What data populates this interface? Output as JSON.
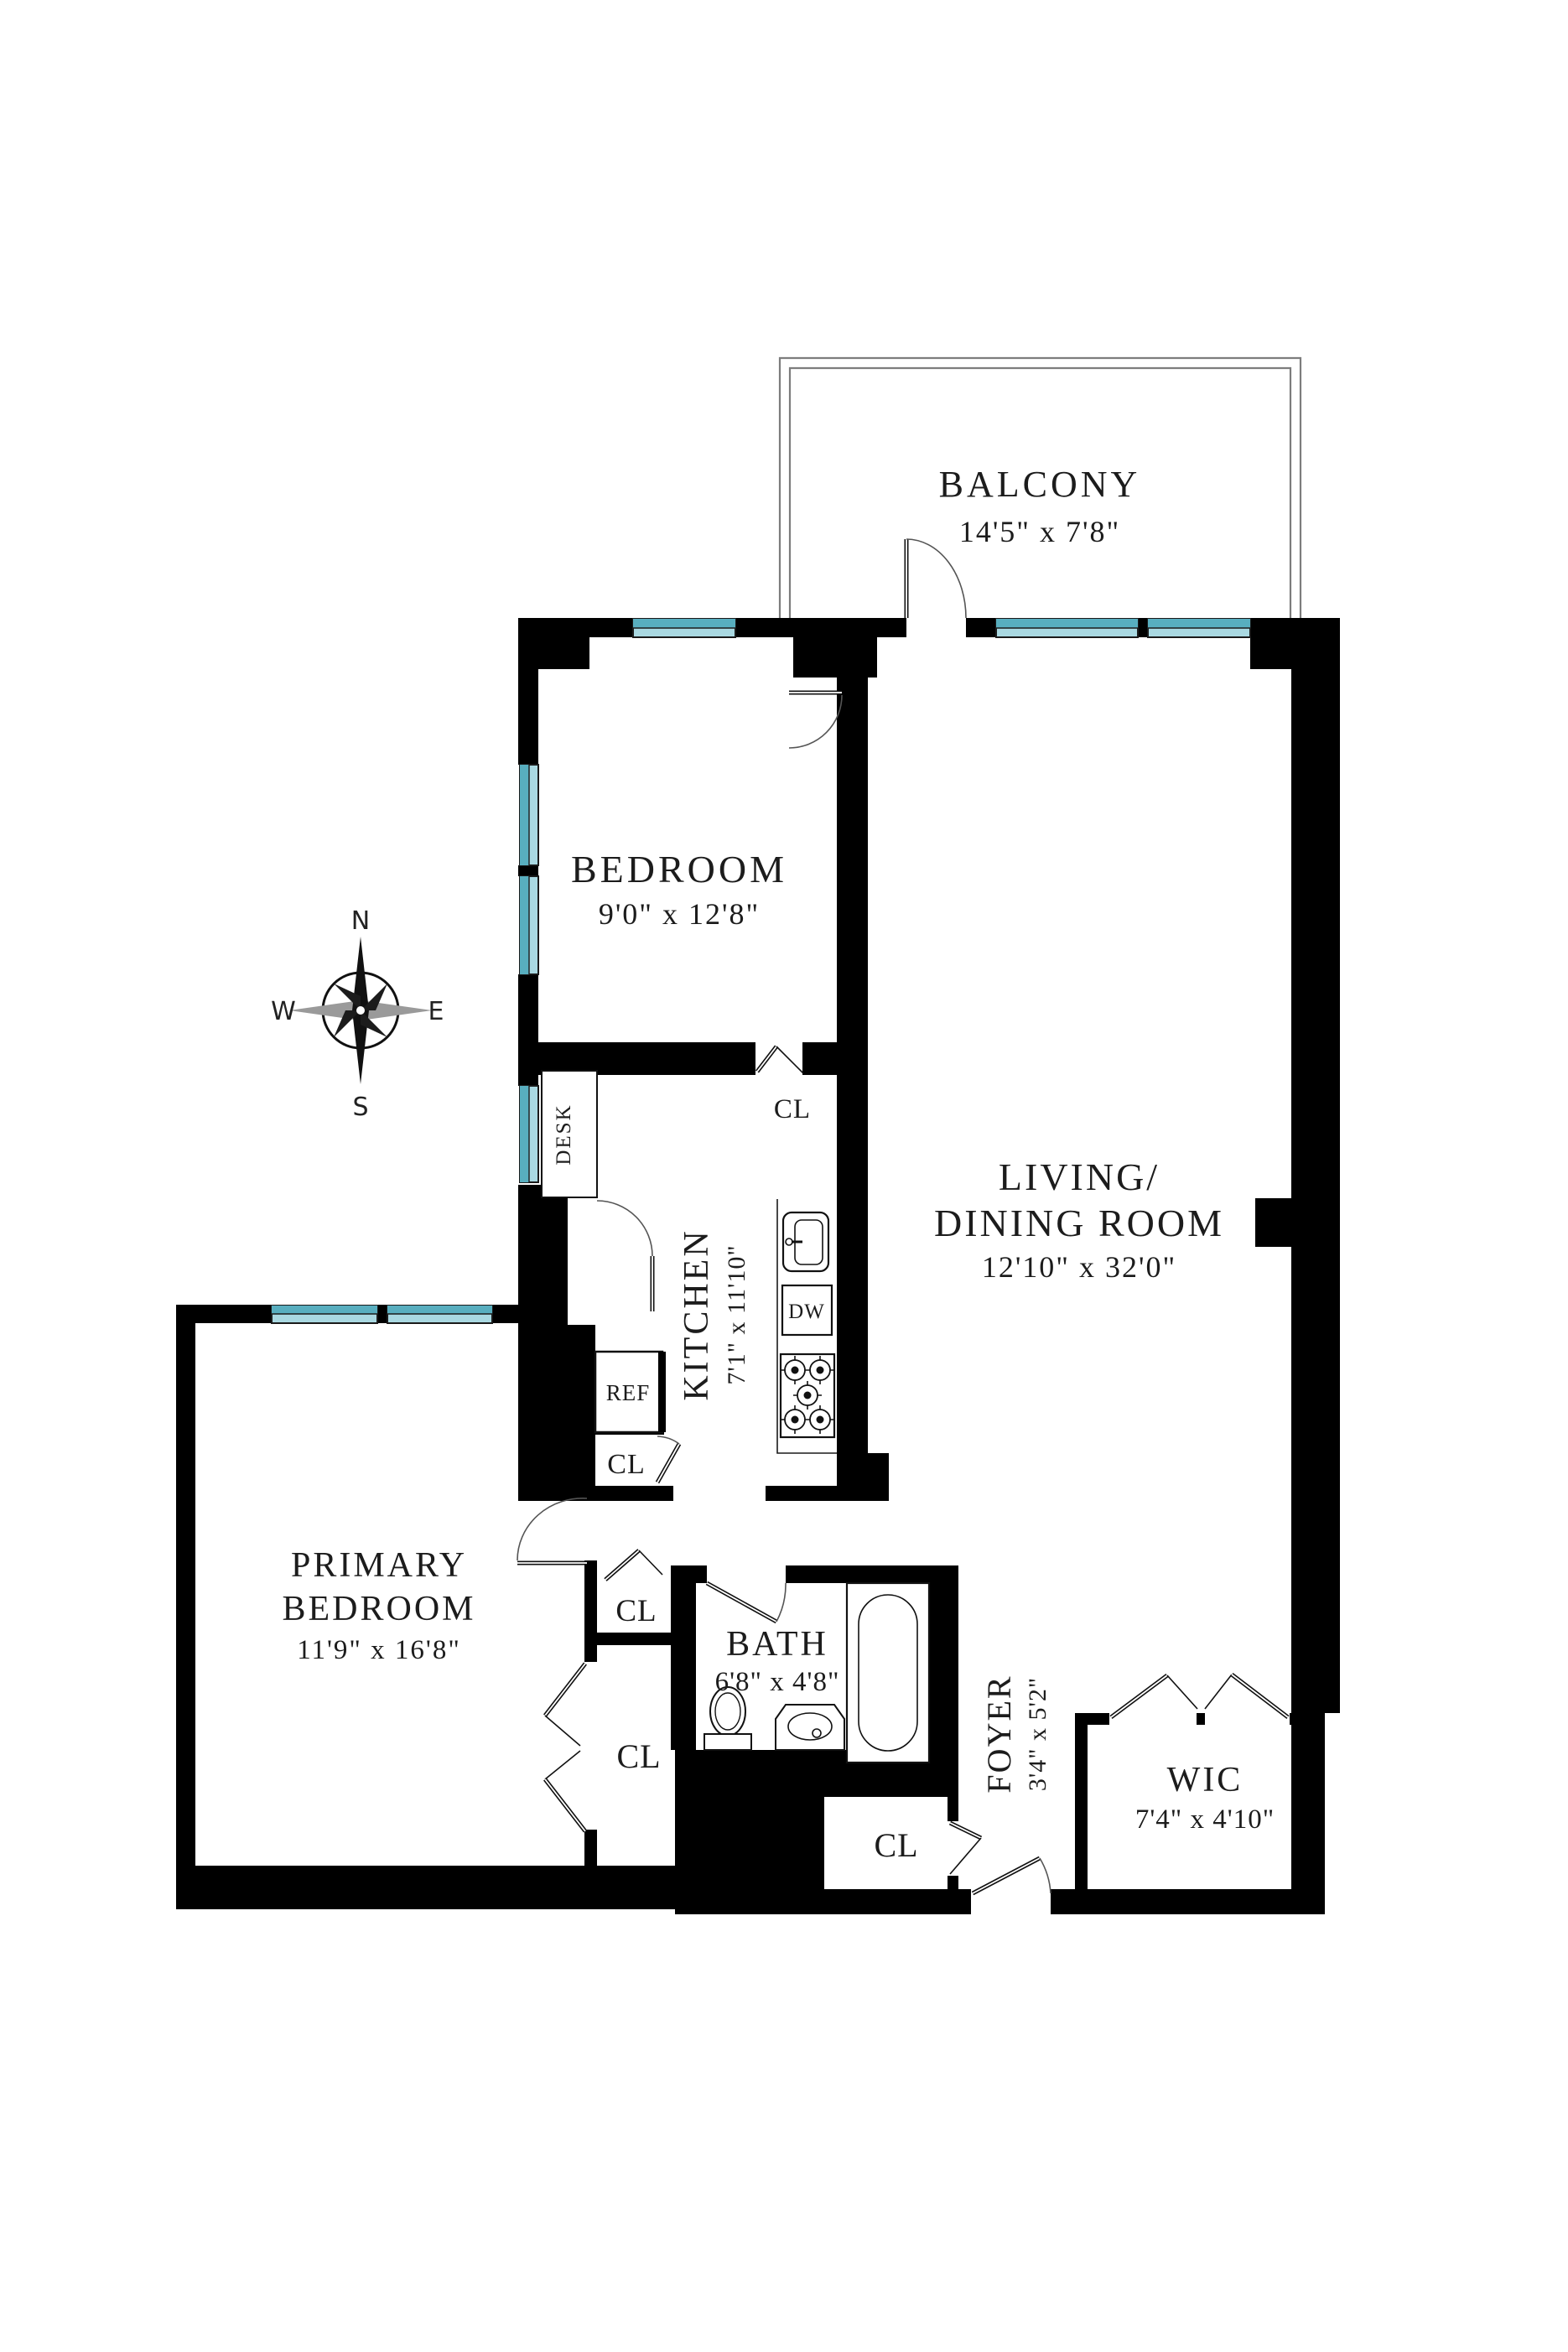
{
  "title": "Apartment Floor Plan",
  "colors": {
    "wall": "#000000",
    "balcony_wall": "#7d7d7d",
    "window_dark": "#58aebf",
    "window_light": "#a9d8e1",
    "label_text": "#1c1c1c",
    "compass_gray": "#9a9a9a",
    "background": "#ffffff"
  },
  "rooms": {
    "balcony": {
      "name": "BALCONY",
      "dims": "14'5\" x 7'8\""
    },
    "bedroom": {
      "name": "BEDROOM",
      "dims": "9'0\" x 12'8\""
    },
    "living_dining": {
      "name_line1": "LIVING/",
      "name_line2": "DINING ROOM",
      "dims": "12'10\" x 32'0\""
    },
    "kitchen": {
      "name": "KITCHEN",
      "dims": "7'1\" x 11'10\""
    },
    "primary_bedroom": {
      "name_line1": "PRIMARY",
      "name_line2": "BEDROOM",
      "dims": "11'9\" x 16'8\""
    },
    "bath": {
      "name": "BATH",
      "dims": "6'8\" x 4'8\""
    },
    "foyer": {
      "name": "FOYER",
      "dims": "3'4\" x 5'2\""
    },
    "wic": {
      "name": "WIC",
      "dims": "7'4\" x 4'10\""
    }
  },
  "closets": {
    "bedroom_closet": "CL",
    "kitchen_closet": "CL",
    "hall_closet": "CL",
    "primary_closet": "CL",
    "coat_closet": "CL"
  },
  "fixtures": {
    "desk": "DESK",
    "refrigerator": "REF",
    "dishwasher": "DW"
  },
  "compass": {
    "north": "N",
    "south": "S",
    "east": "E",
    "west": "W"
  },
  "icons": [
    "compass-rose-icon",
    "toilet-icon",
    "bathtub-icon",
    "vanity-sink-icon",
    "kitchen-sink-icon",
    "stove-icon",
    "window-glyph",
    "door-swing-glyph",
    "bifold-door-glyph"
  ]
}
